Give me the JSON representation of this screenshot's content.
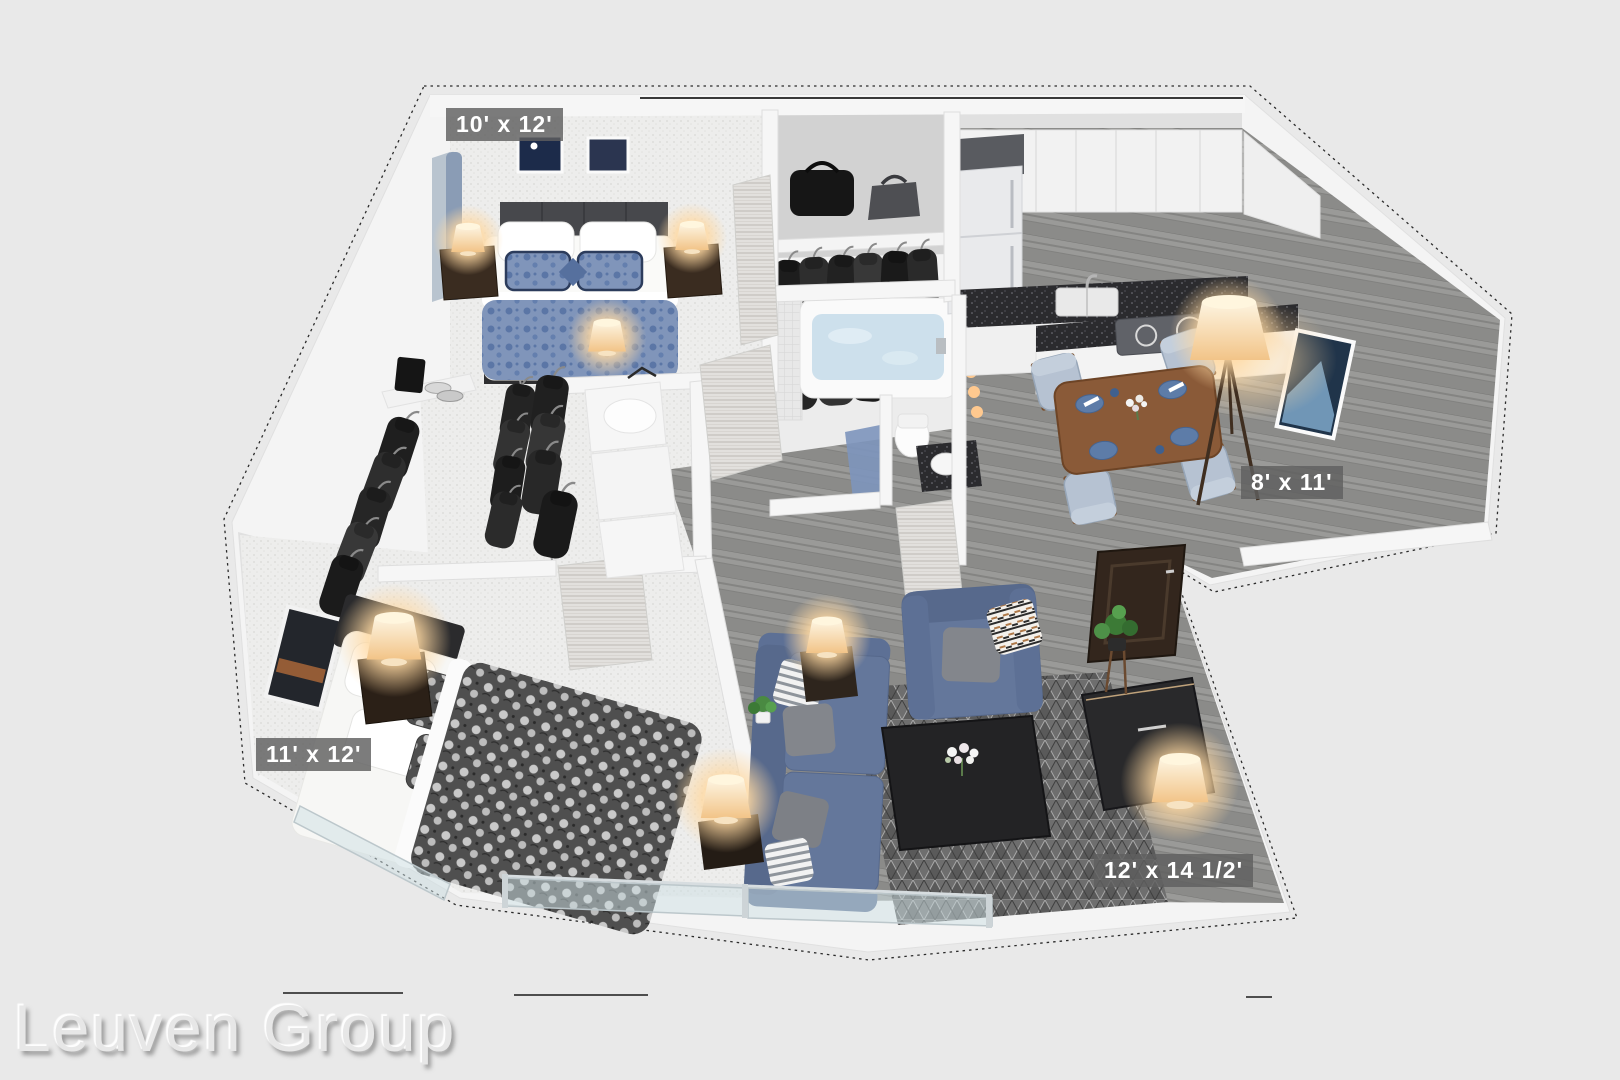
{
  "watermark": {
    "text": "Leuven Group"
  },
  "rooms": [
    {
      "name": "bedroom-top",
      "label": "10' x 12'"
    },
    {
      "name": "dining-area",
      "label": "8' x 11'"
    },
    {
      "name": "bedroom-bottom",
      "label": "11' x 12'"
    },
    {
      "name": "living-room",
      "label": "12' x 14 1/2'"
    }
  ],
  "scene": {
    "type": "3d-isometric-floor-plan",
    "colors": {
      "background": "#e9e9e9",
      "walls": "#f4f4f4",
      "wall_face": "#d8d8d8",
      "carpet": "#ededec",
      "wood_floor": "#949492",
      "accent_blue": "#64779b",
      "bedding_blue": "#8095ba",
      "dining_chair": "#b6c2d2",
      "table_wood": "#8a5a38",
      "counter_dark": "#2b2b2e",
      "rug_gray": "#6e6e6e",
      "clothes_dark": "#222222",
      "lamp_glow": "#ffd9a2",
      "label_background": "rgba(95,95,95,0.82)",
      "label_text": "#ffffff",
      "dimension_line": "#2b2b2b"
    }
  }
}
